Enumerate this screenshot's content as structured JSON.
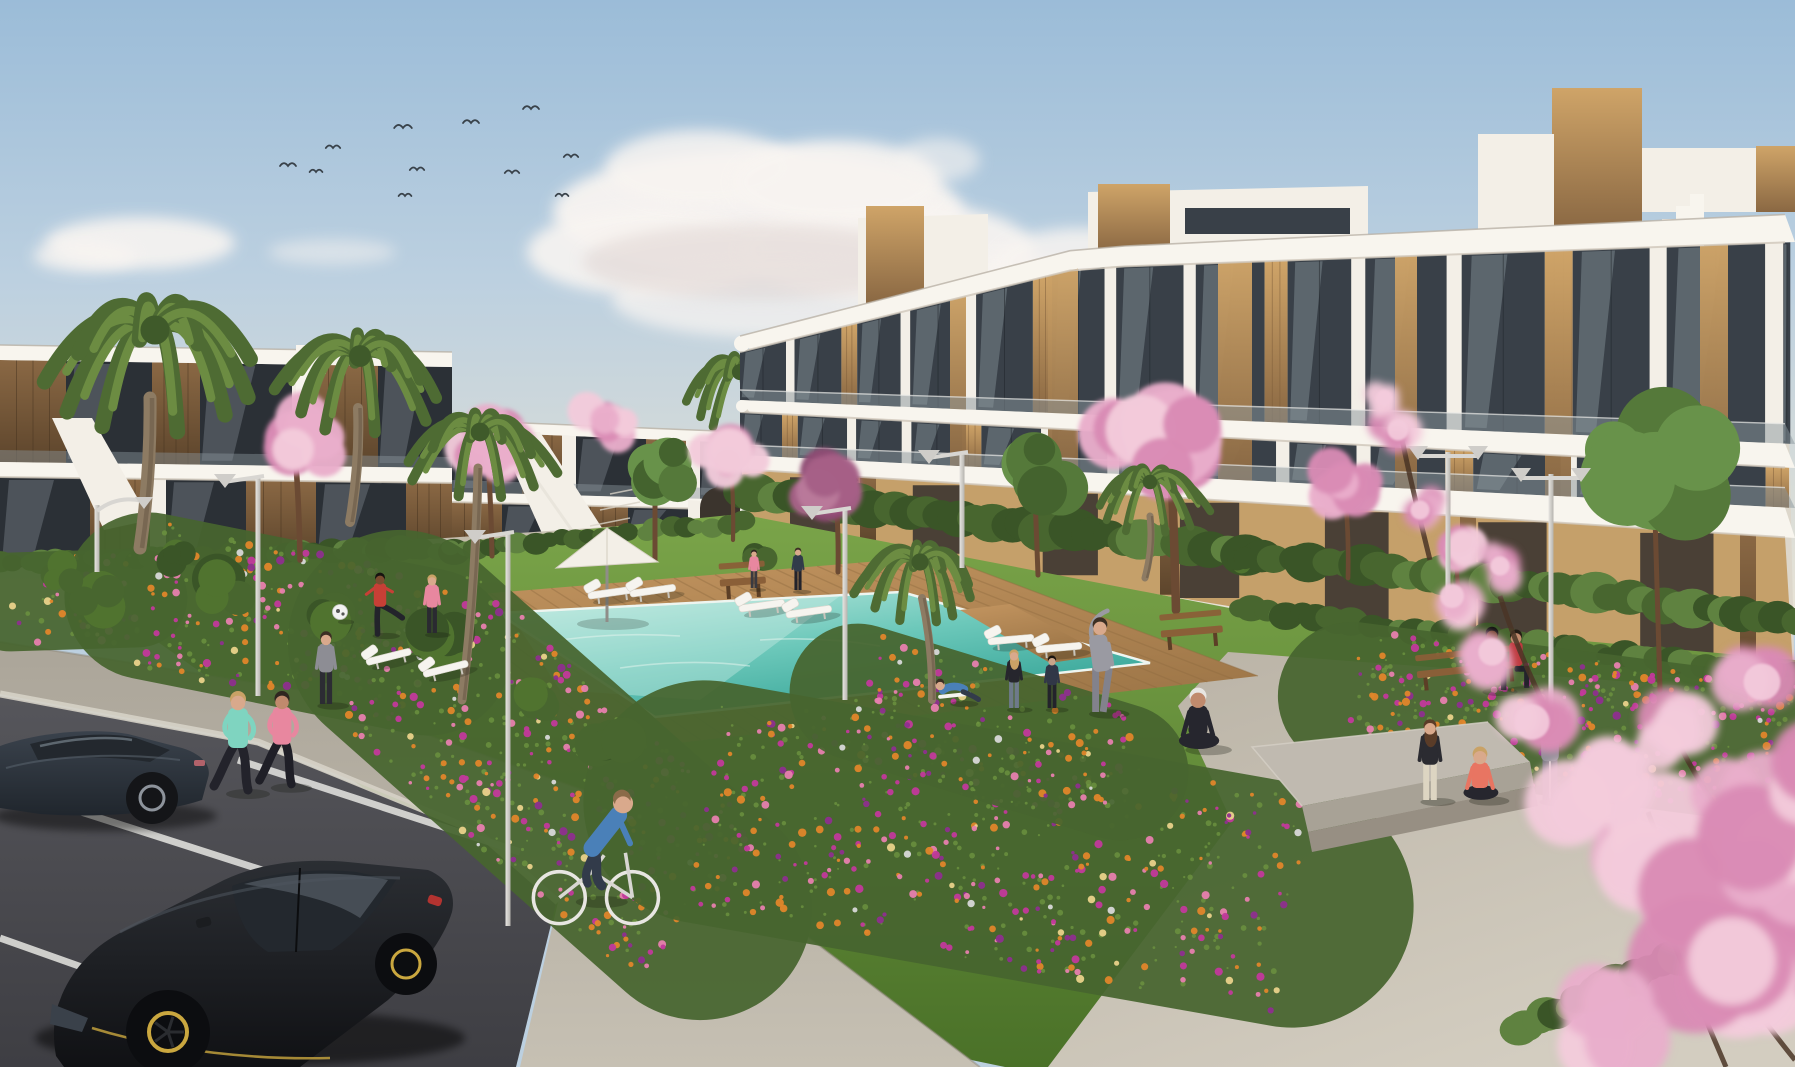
{
  "scene": {
    "setting": "sunny 3D architectural rendering of a white modern apartment complex with courtyard pool, lawns, flower beds, cherry-blossom trees, palms, residents exercising, and a foreground parking lot with dark cars",
    "palette": {
      "skyTop": "#9bbcd8",
      "skyMid": "#bcd0e0",
      "skyLow": "#d8dcd8",
      "horizon": "#e9e3d5",
      "cloud": "#f8f4f1",
      "cloudShade": "#ddd1cf",
      "white": "#f3efe7",
      "whiteShade": "#ddd7cb",
      "slab": "#f8f5ee",
      "slabEdge": "#cfc7ba",
      "glass": "#394048",
      "glassLight": "#a9b6bd",
      "rail": "#8a959b",
      "woodL": "#cfa468",
      "woodD": "#8a6843",
      "ochre": "#c5a06a",
      "opening": "#4a4036",
      "hedge": "#48662f",
      "hedgeL": "#5f8240",
      "hedgeD": "#3a5527",
      "lawnT": "#7aa449",
      "lawnB": "#4a7128",
      "deckT": "#c39560",
      "deckB": "#9b7446",
      "plank": "#8f6b40",
      "poolL": "#c2ebe1",
      "poolM": "#6cc8ba",
      "poolD": "#2fa093",
      "coping": "#eef5f0",
      "walkT": "#aba599",
      "walkB": "#c6c0b3",
      "plazaT": "#b9b2a5",
      "plazaB": "#d3cdc0",
      "asphaltT": "#56565b",
      "asphaltB": "#3e3e43",
      "curb": "#d6d1c6",
      "line": "#e6e6e2",
      "soil": "#47652f",
      "leaf": "#6d9340",
      "fOrange": "#e0862a",
      "fMagenta": "#c2399b",
      "fPink": "#e77fae",
      "fViolet": "#8e2f8e",
      "fCream": "#e9d28a",
      "blossom": "#e9aecb",
      "blossomL": "#f3cbdb",
      "blossomD": "#d98ab4",
      "purTree1": "#a65f86",
      "purTree2": "#8e4a72",
      "trunk": "#6b4a33",
      "branch": "#4a3526",
      "palmD": "#4e6b33",
      "palmL": "#6c8c42",
      "palmTrunk": "#8d7b63",
      "poleL": "#e8e6e2",
      "poleD": "#b5b3ae",
      "carBodyT": "#3a424c",
      "carBodyB": "#20262d",
      "hatchT": "#2b2e33",
      "hatchB": "#101114",
      "rimGold": "#caa73f",
      "glassCar": "#23282e",
      "glassStreak": "#98a6b0",
      "benchWood": "#8a5f38",
      "benchLeg": "#5c3f26",
      "concrete": "#c0bab0",
      "concreteFace": "#a8a296"
    },
    "sky": {
      "birds": [
        [
          288,
          166,
          1
        ],
        [
          316,
          172,
          0.8
        ],
        [
          333,
          148,
          0.9
        ],
        [
          403,
          128,
          1.1
        ],
        [
          417,
          170,
          0.9
        ],
        [
          405,
          196,
          0.8
        ],
        [
          471,
          123,
          1
        ],
        [
          512,
          173,
          0.9
        ],
        [
          531,
          109,
          1
        ],
        [
          562,
          196,
          0.8
        ],
        [
          571,
          157,
          0.9
        ]
      ],
      "clouds": [
        [
          758,
          212,
          205,
          62,
          0.95,
          0
        ],
        [
          652,
          252,
          125,
          44,
          0.9,
          0
        ],
        [
          886,
          250,
          148,
          50,
          0.92,
          0
        ],
        [
          700,
          168,
          95,
          38,
          0.85,
          0
        ],
        [
          836,
          182,
          105,
          42,
          0.9,
          0
        ],
        [
          772,
          300,
          160,
          38,
          0.75,
          0
        ],
        [
          758,
          262,
          175,
          38,
          0.5,
          1
        ],
        [
          140,
          243,
          95,
          26,
          0.9,
          0
        ],
        [
          85,
          256,
          52,
          16,
          0.8,
          0
        ],
        [
          332,
          252,
          64,
          13,
          0.5,
          0
        ],
        [
          1000,
          302,
          128,
          46,
          0.9,
          0
        ],
        [
          1082,
          262,
          88,
          34,
          0.85,
          0
        ],
        [
          938,
          160,
          42,
          22,
          0.6,
          0
        ]
      ]
    },
    "lamps": [
      [
        97,
        505,
        572,
        "curve"
      ],
      [
        258,
        476,
        696,
        "cup"
      ],
      [
        508,
        532,
        926,
        "cup"
      ],
      [
        845,
        508,
        700,
        "cup"
      ],
      [
        962,
        452,
        568,
        "cup"
      ],
      [
        1448,
        452,
        616,
        "double"
      ],
      [
        1551,
        474,
        800,
        "double"
      ]
    ],
    "loungers": [
      [
        390,
        658,
        -14
      ],
      [
        447,
        670,
        -14
      ],
      [
        612,
        594,
        -8
      ],
      [
        654,
        592,
        -8
      ],
      [
        763,
        607,
        -8
      ],
      [
        810,
        613,
        -8
      ],
      [
        1012,
        641,
        -5
      ],
      [
        1060,
        649,
        -5
      ]
    ],
    "benches": [
      [
        1468,
        672,
        102,
        -6
      ],
      [
        1192,
        634,
        62,
        -5
      ],
      [
        743,
        584,
        46,
        -4
      ]
    ],
    "platform": {
      "top": [
        [
          1252,
          747
        ],
        [
          1488,
          722
        ],
        [
          1530,
          762
        ],
        [
          1302,
          806
        ]
      ],
      "face": [
        [
          1302,
          806
        ],
        [
          1530,
          762
        ],
        [
          1534,
          786
        ],
        [
          1308,
          832
        ]
      ],
      "step": [
        [
          1308,
          832
        ],
        [
          1534,
          786
        ],
        [
          1538,
          806
        ],
        [
          1312,
          852
        ]
      ]
    },
    "umbrella": {
      "peak": [
        607,
        528
      ],
      "left": [
        556,
        568
      ],
      "right": [
        658,
        562
      ],
      "poleBottom": [
        607,
        622
      ]
    },
    "ball": {
      "x": 340,
      "y": 612,
      "r": 7.5
    },
    "pool": {
      "corners": [
        [
          498,
          613
        ],
        [
          902,
          592
        ],
        [
          1150,
          663
        ],
        [
          655,
          717
        ]
      ],
      "bridge": [
        [
          960,
          610
        ],
        [
          1010,
          604
        ],
        [
          1105,
          655
        ],
        [
          1050,
          663
        ]
      ]
    },
    "deck": {
      "corners": [
        [
          408,
          600
        ],
        [
          940,
          556
        ],
        [
          1258,
          676
        ],
        [
          600,
          752
        ]
      ]
    },
    "flower_strips": [
      [
        10,
        602,
        138,
        598,
        52,
        40
      ],
      [
        148,
        596,
        428,
        652,
        88,
        150
      ],
      [
        400,
        642,
        700,
        908,
        118,
        260
      ],
      [
        705,
        802,
        1292,
        906,
        128,
        330
      ],
      [
        858,
        692,
        1120,
        772,
        72,
        110
      ],
      [
        1352,
        696,
        1788,
        752,
        78,
        260
      ]
    ],
    "hedge_strips": [
      [
        742,
        492,
        1795,
        620,
        21,
        64
      ],
      [
        1240,
        608,
        1795,
        676,
        14,
        46
      ],
      [
        1515,
        1030,
        1795,
        904,
        19,
        28
      ],
      [
        0,
        563,
        452,
        549,
        13,
        34
      ],
      [
        452,
        549,
        740,
        523,
        11,
        22
      ]
    ],
    "shrubs": [
      [
        95,
        600,
        34
      ],
      [
        222,
        584,
        40
      ],
      [
        328,
        610,
        34
      ],
      [
        442,
        636,
        38
      ],
      [
        180,
        560,
        22
      ],
      [
        60,
        572,
        26
      ],
      [
        540,
        700,
        30
      ],
      [
        610,
        745,
        34
      ],
      [
        760,
        560,
        18
      ],
      [
        1240,
        560,
        16
      ]
    ],
    "parking_lines": [
      [
        0,
        786,
        368,
        904
      ],
      [
        0,
        938,
        276,
        1036
      ],
      [
        238,
        760,
        520,
        852
      ],
      [
        64,
        1040,
        150,
        1067
      ]
    ],
    "green_trees": [
      [
        655,
        470,
        45,
        655,
        560
      ],
      [
        1035,
        470,
        52,
        1038,
        575
      ],
      [
        1655,
        470,
        92,
        1660,
        690
      ]
    ],
    "blossom_trees": [
      [
        295,
        440,
        62,
        300,
        560,
        "pink"
      ],
      [
        487,
        438,
        56,
        492,
        556,
        "pink"
      ],
      [
        730,
        450,
        46,
        733,
        540,
        "pink"
      ],
      [
        835,
        482,
        56,
        838,
        572,
        "purple"
      ],
      [
        1170,
        428,
        95,
        1176,
        610,
        "pink"
      ],
      [
        1345,
        486,
        52,
        1348,
        578,
        "pink"
      ],
      [
        1455,
        546,
        44,
        1458,
        618,
        "pink"
      ],
      [
        605,
        420,
        38,
        0,
        0,
        "pink"
      ]
    ],
    "palms_back": [
      [
        1165,
        215,
        72
      ],
      [
        740,
        372,
        62
      ]
    ],
    "palms": [
      [
        155,
        330,
        112,
        150,
        398,
        140,
        548,
        13
      ],
      [
        360,
        356,
        84,
        358,
        408,
        350,
        522,
        10
      ],
      [
        480,
        432,
        72,
        478,
        468,
        462,
        700,
        9
      ],
      [
        920,
        562,
        66,
        922,
        598,
        932,
        700,
        8
      ],
      [
        1150,
        482,
        56,
        1150,
        516,
        1145,
        578,
        7
      ]
    ],
    "people": [
      {
        "x": 238,
        "y": 792,
        "h": 100,
        "pose": "run",
        "top": "#7fd4c0",
        "bottom": "#23232b",
        "skin": "#d9a98c",
        "hair": "#c9a266"
      },
      {
        "x": 282,
        "y": 786,
        "h": 94,
        "pose": "run",
        "top": "#e8879f",
        "bottom": "#1f1f27",
        "skin": "#c08a6d",
        "hair": "#2f2620"
      },
      {
        "x": 590,
        "y": 900,
        "h": 118,
        "pose": "bike",
        "top": "#4a80b8",
        "bottom": "#323b4a",
        "skin": "#d9a98c",
        "hair": "#8a6b49"
      },
      {
        "x": 326,
        "y": 704,
        "h": 72,
        "pose": "stand",
        "top": "#8d8d94",
        "bottom": "#2c2c33",
        "skin": "#d9a98c",
        "hair": "#3c2f24"
      },
      {
        "x": 380,
        "y": 634,
        "h": 62,
        "pose": "kick",
        "top": "#c73f36",
        "bottom": "#23232b",
        "skin": "#7c4c30",
        "hair": "#171310"
      },
      {
        "x": 432,
        "y": 633,
        "h": 58,
        "pose": "stand",
        "top": "#e8879f",
        "bottom": "#2a2a31",
        "skin": "#d9a98c",
        "hair": "#c9a266"
      },
      {
        "x": 958,
        "y": 702,
        "h": 64,
        "pose": "lounge",
        "top": "#4a80b8",
        "bottom": "#323b4a",
        "skin": "#d9a98c",
        "hair": "#3c2f24"
      },
      {
        "x": 1014,
        "y": 708,
        "h": 58,
        "pose": "stand",
        "top": "#26262d",
        "bottom": "#6e7a8a",
        "skin": "#d9a98c",
        "hair": "#c9a266",
        "hairLong": true
      },
      {
        "x": 1052,
        "y": 708,
        "h": 52,
        "pose": "stand",
        "top": "#313747",
        "bottom": "#23232b",
        "skin": "#caa58a",
        "hair": "#1b1510"
      },
      {
        "x": 1100,
        "y": 712,
        "h": 92,
        "pose": "stretch",
        "top": "#9a9aa2",
        "bottom": "#82828c",
        "skin": "#d9a98c",
        "hair": "#3c2f24"
      },
      {
        "x": 1198,
        "y": 748,
        "h": 106,
        "pose": "sit",
        "top": "#26262e",
        "bottom": "#26262e",
        "skin": "#c08a6d",
        "hair": "#1b1510",
        "cap": "#e8e6e2"
      },
      {
        "x": 1430,
        "y": 800,
        "h": 80,
        "pose": "stand",
        "top": "#2b2b31",
        "bottom": "#ddd5c2",
        "skin": "#d9a98c",
        "hair": "#5a3c28",
        "hairLong": true
      },
      {
        "x": 1480,
        "y": 799,
        "h": 92,
        "pose": "sit",
        "top": "#e87562",
        "bottom": "#26262e",
        "skin": "#d9a98c",
        "hair": "#c9a266"
      },
      {
        "x": 1550,
        "y": 800,
        "h": 88,
        "pose": "armsup",
        "top": "#8f8f97",
        "bottom": "#77777f",
        "skin": "#caa58a",
        "hair": "#241c15"
      },
      {
        "x": 1492,
        "y": 690,
        "h": 80,
        "pose": "sitbench",
        "top": "#3b63a8",
        "bottom": "#23232b",
        "skin": "#6e4128",
        "hair": "#101010"
      },
      {
        "x": 1516,
        "y": 688,
        "h": 74,
        "pose": "sitbench",
        "top": "#bf3a3f",
        "bottom": "#23232b",
        "skin": "#c08a6d",
        "hair": "#241c15"
      },
      {
        "x": 798,
        "y": 590,
        "h": 42,
        "pose": "stand",
        "top": "#313b4a",
        "bottom": "#23232b",
        "skin": "#d9a98c",
        "hair": "#3c2f24"
      },
      {
        "x": 754,
        "y": 588,
        "h": 38,
        "pose": "stand",
        "top": "#e8879f",
        "bottom": "#3a3a40",
        "skin": "#d9a98c",
        "hair": "#2f2620"
      }
    ],
    "fg_branches": [
      [
        1795,
        1060,
        1690,
        930,
        1648,
        812
      ],
      [
        1795,
        910,
        1716,
        818,
        1678,
        742
      ],
      [
        1726,
        1067,
        1676,
        950,
        1640,
        860
      ],
      [
        1560,
        736,
        1520,
        660,
        1500,
        596
      ],
      [
        1430,
        560,
        1410,
        480,
        1398,
        420
      ]
    ],
    "fg_blossoms": [
      [
        1398,
        430,
        26
      ],
      [
        1420,
        510,
        24
      ],
      [
        1452,
        596,
        30
      ],
      [
        1492,
        652,
        34
      ],
      [
        1532,
        722,
        44
      ],
      [
        1592,
        796,
        60
      ],
      [
        1655,
        856,
        72
      ],
      [
        1722,
        912,
        82
      ],
      [
        1779,
        968,
        92
      ],
      [
        1680,
        742,
        52
      ],
      [
        1742,
        822,
        62
      ],
      [
        1786,
        876,
        78
      ],
      [
        1762,
        682,
        46
      ],
      [
        1700,
        1002,
        92
      ],
      [
        1608,
        1032,
        72
      ],
      [
        1500,
        566,
        24
      ],
      [
        1384,
        398,
        20
      ],
      [
        1795,
        770,
        60
      ]
    ]
  }
}
